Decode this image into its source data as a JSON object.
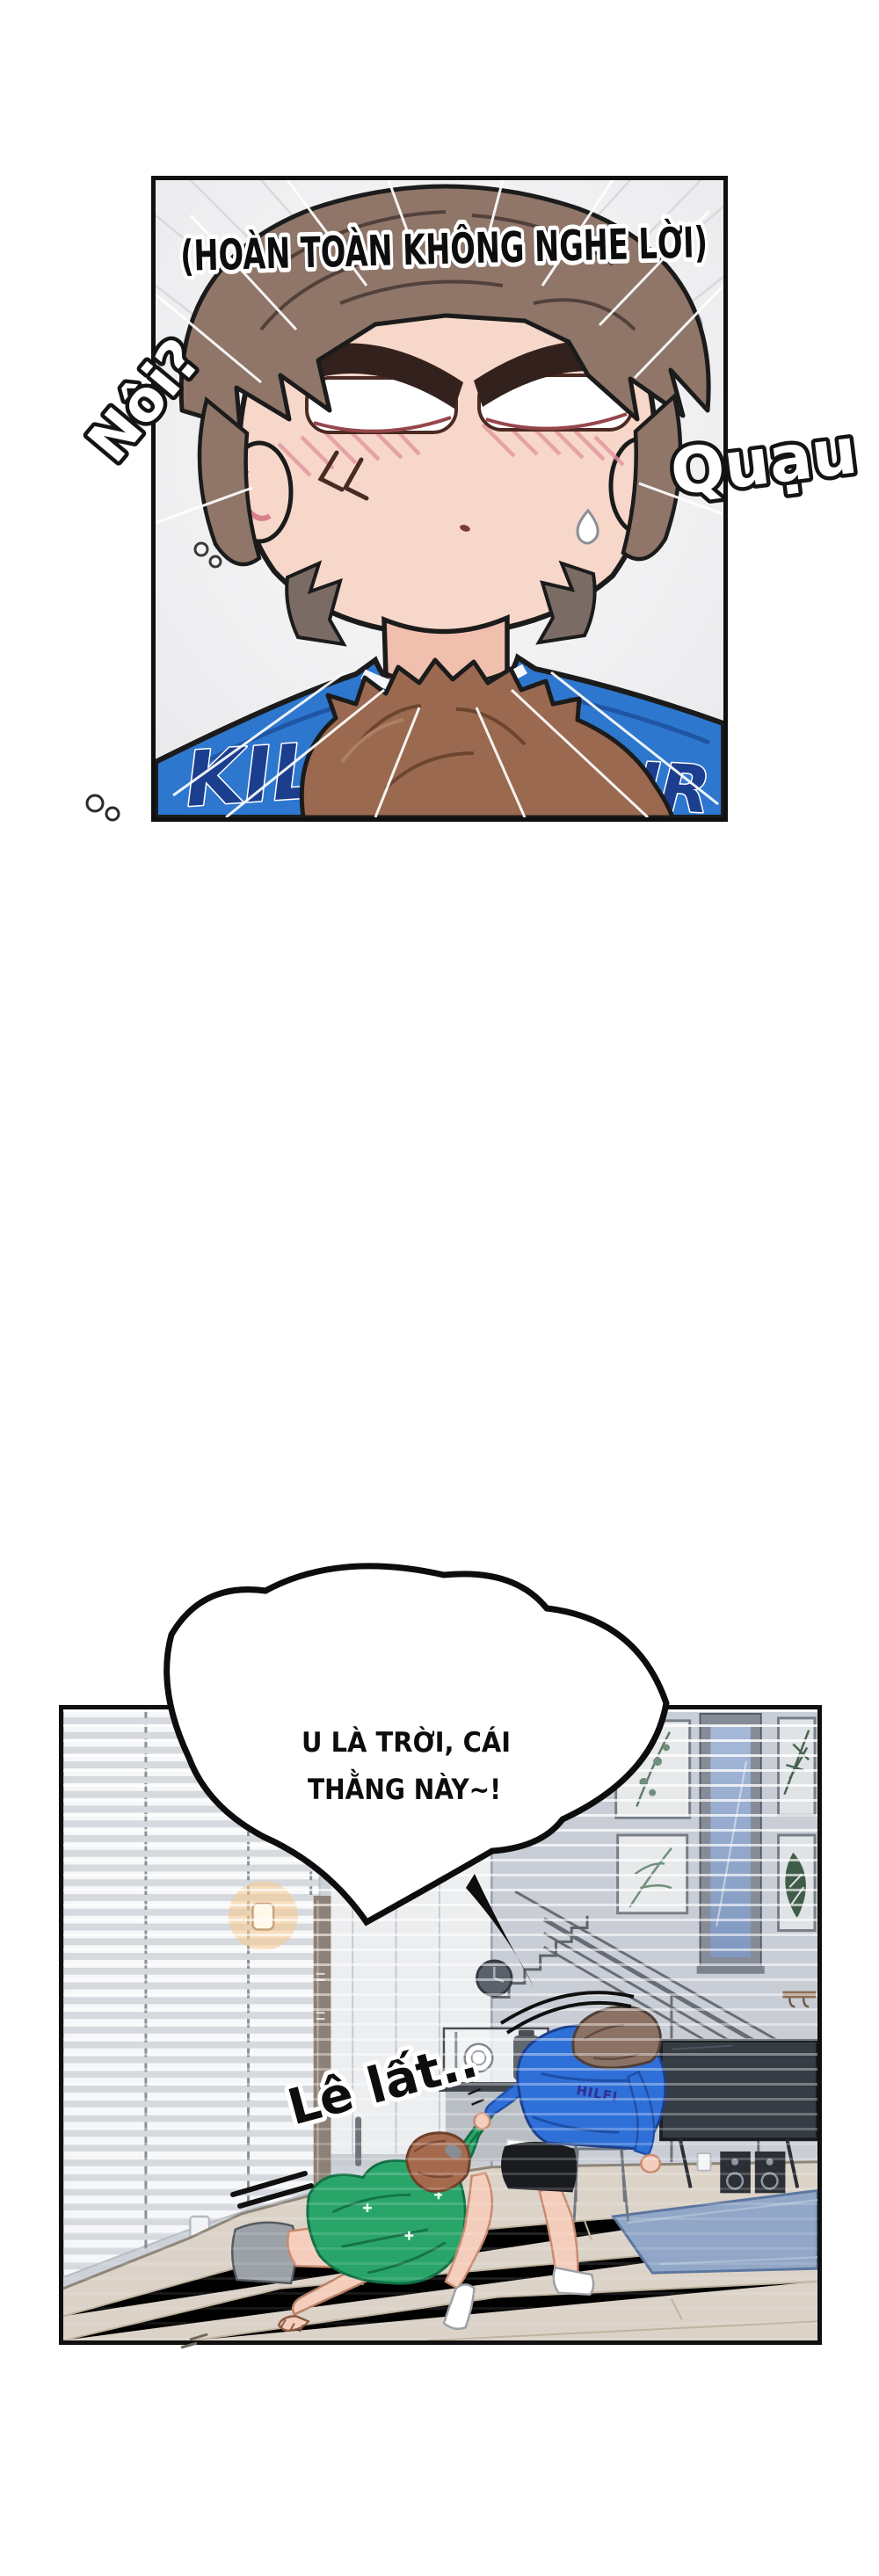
{
  "page": {
    "background": "#ffffff"
  },
  "panel1": {
    "caption": "(HOÀN TOÀN KHÔNG NGHE LỜI)",
    "sfx_left": "Nôi?",
    "sfx_right": "Quạu",
    "shirt_text_left": "KIL",
    "shirt_text_right": "FIGHR",
    "colors": {
      "background": "#f0f0f2",
      "skin": "#f6d7c9",
      "hair_brown": "#8f7669",
      "shirt_blue": "#2e77cf",
      "shirt_letters_navy": "#1c3e8e",
      "foreground_hair": "#9a6950",
      "blush_pink": "#e3969f"
    }
  },
  "panel2": {
    "bubble_line1": "U LÀ TRỜI, CÁI",
    "bubble_line2": "THẰNG NÀY~!",
    "sfx_drag": "Lê lất..",
    "shirt_text": "HILFI",
    "colors": {
      "wall": "#c9cdd6",
      "hall_wall": "#eceef0",
      "blinds": "#f6f7f8",
      "floor_wood": "#dcd3c8",
      "rug_blue": "#92a7c7",
      "sweater_green": "#2aa56a",
      "sweater_blue": "#2f70d8",
      "tv_dark": "#363c44",
      "glass_blue": "#a6b9d8"
    }
  }
}
